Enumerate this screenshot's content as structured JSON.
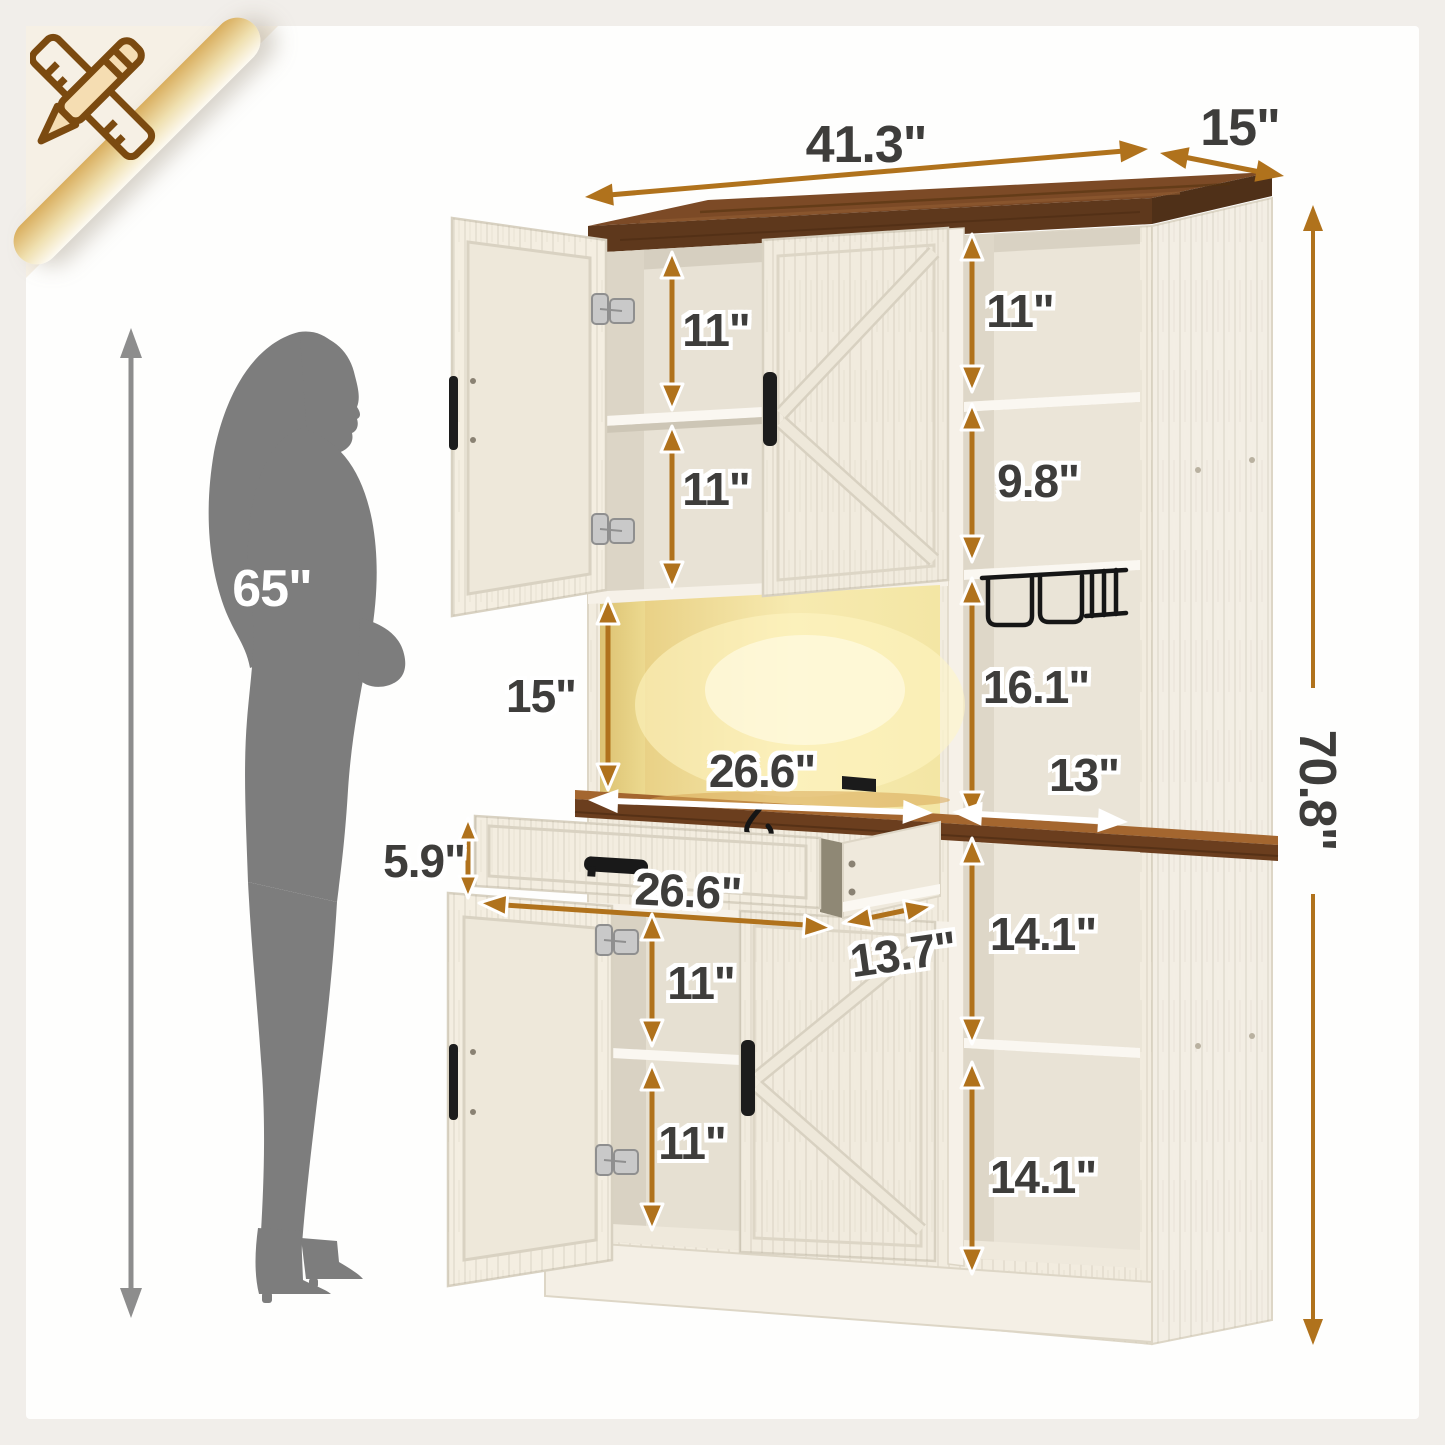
{
  "icons": {
    "corner_icon": "ruler-pencil-icon",
    "person_figure": "woman-silhouette-icon"
  },
  "person": {
    "height": "65\""
  },
  "dims": {
    "total_width": "41.3\"",
    "total_depth": "15\"",
    "total_height": "70.8\"",
    "upper_left_shelf_top": "11\"",
    "upper_left_shelf_bottom": "11\"",
    "upper_right_cubby_top": "11\"",
    "upper_right_cubby_middle": "9.8\"",
    "hutch_open_height": "15\"",
    "hutch_open_width": "26.6\"",
    "right_mid_cubby_height": "16.1\"",
    "right_mid_cubby_depth": "13\"",
    "drawer_height": "5.9\"",
    "drawer_width": "26.6\"",
    "drawer_depth": "13.7\"",
    "lower_left_shelf_top": "11\"",
    "lower_left_shelf_bottom": "11\"",
    "lower_right_cubby_top": "14.1\"",
    "lower_right_cubby_bottom": "14.1\""
  },
  "colors": {
    "accent_arrow": "#b0721c",
    "white_arrow": "#ffffff",
    "dimension_text": "#3e3d3b",
    "top_wood": "#7c4a26",
    "counter_wood": "#6b3e1e",
    "cabinet_cream": "#f2ecdf",
    "led_glow": "#f9f0bd",
    "silhouette_gray": "#7d7d7d",
    "page_beige": "#f6f0e5"
  }
}
